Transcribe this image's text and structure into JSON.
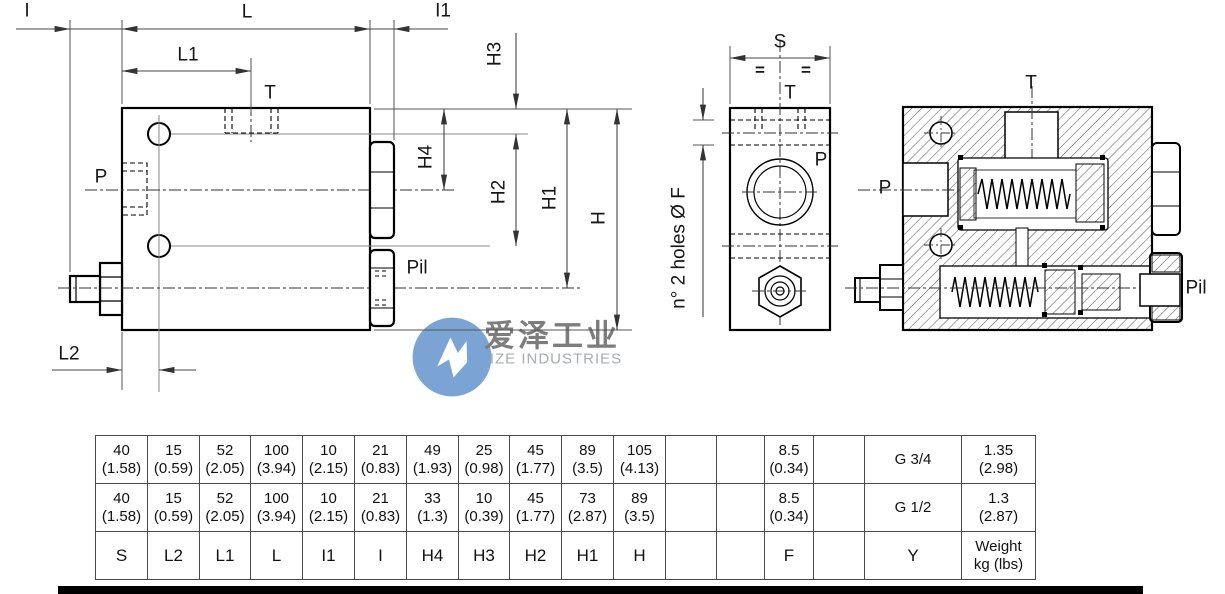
{
  "drawing": {
    "front_view": {
      "dim_I": "I",
      "dim_L": "L",
      "dim_L1": "L1",
      "dim_I1": "I1",
      "dim_L2": "L2",
      "dim_H": "H",
      "dim_H1": "H1",
      "dim_H2": "H2",
      "dim_H3": "H3",
      "dim_H4": "H4",
      "port_T": "T",
      "port_P": "P",
      "port_Pil": "Pil"
    },
    "side_view": {
      "dim_S": "S",
      "eq_left": "=",
      "eq_right": "=",
      "port_T": "T",
      "port_P": "P",
      "holes_note": "n° 2 holes Ø F"
    },
    "section_view": {
      "port_T": "T",
      "port_P": "P",
      "port_Pil": "Pil"
    }
  },
  "watermark": {
    "cn_name": "爱泽工业",
    "en_name": "IZE INDUSTRIES",
    "logo_color": "#7ba3d4"
  },
  "table": {
    "rows": [
      {
        "cells": [
          {
            "v": "40",
            "s": "(1.58)"
          },
          {
            "v": "15",
            "s": "(0.59)"
          },
          {
            "v": "52",
            "s": "(2.05)"
          },
          {
            "v": "100",
            "s": "(3.94)"
          },
          {
            "v": "10",
            "s": "(2.15)"
          },
          {
            "v": "21",
            "s": "(0.83)"
          },
          {
            "v": "49",
            "s": "(1.93)"
          },
          {
            "v": "25",
            "s": "(0.98)"
          },
          {
            "v": "45",
            "s": "(1.77)"
          },
          {
            "v": "89",
            "s": "(3.5)"
          },
          {
            "v": "105",
            "s": "(4.13)"
          },
          {
            "v": ""
          },
          {
            "v": ""
          },
          {
            "v": "8.5",
            "s": "(0.34)"
          },
          {
            "v": ""
          },
          {
            "v": "G 3/4"
          },
          {
            "v": "1.35",
            "s": "(2.98)"
          }
        ]
      },
      {
        "cells": [
          {
            "v": "40",
            "s": "(1.58)"
          },
          {
            "v": "15",
            "s": "(0.59)"
          },
          {
            "v": "52",
            "s": "(2.05)"
          },
          {
            "v": "100",
            "s": "(3.94)"
          },
          {
            "v": "10",
            "s": "(2.15)"
          },
          {
            "v": "21",
            "s": "(0.83)"
          },
          {
            "v": "33",
            "s": "(1.3)"
          },
          {
            "v": "10",
            "s": "(0.39)"
          },
          {
            "v": "45",
            "s": "(1.77)"
          },
          {
            "v": "73",
            "s": "(2.87)"
          },
          {
            "v": "89",
            "s": "(3.5)"
          },
          {
            "v": ""
          },
          {
            "v": ""
          },
          {
            "v": "8.5",
            "s": "(0.34)"
          },
          {
            "v": ""
          },
          {
            "v": "G 1/2"
          },
          {
            "v": "1.3",
            "s": "(2.87)"
          }
        ]
      },
      {
        "cells": [
          {
            "v": "S"
          },
          {
            "v": "L2"
          },
          {
            "v": "L1"
          },
          {
            "v": "L"
          },
          {
            "v": "I1"
          },
          {
            "v": "I"
          },
          {
            "v": "H4"
          },
          {
            "v": "H3"
          },
          {
            "v": "H2"
          },
          {
            "v": "H1"
          },
          {
            "v": "H"
          },
          {
            "v": ""
          },
          {
            "v": ""
          },
          {
            "v": "F"
          },
          {
            "v": ""
          },
          {
            "v": "Y"
          },
          {
            "v": "Weight",
            "s": "kg (lbs)"
          }
        ]
      }
    ]
  }
}
